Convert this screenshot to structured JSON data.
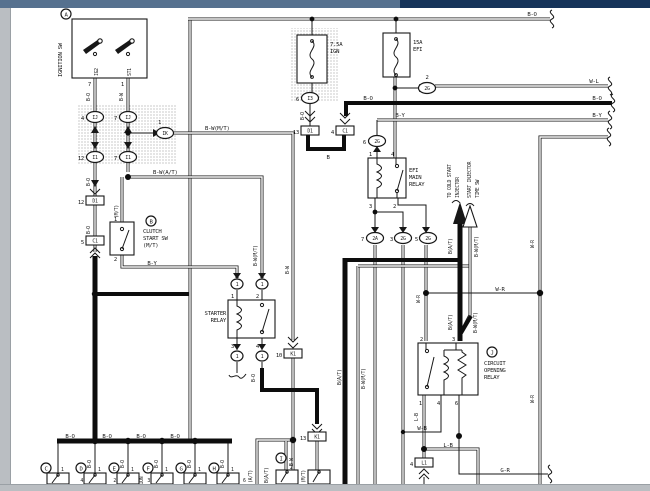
{
  "chrome": {
    "titlebar_left_color": "#56718f",
    "titlebar_right_color": "#16345a",
    "frame_color": "#babec2"
  },
  "ign": {
    "callout": "A",
    "label": "IGNITION SW",
    "t1": "IG2",
    "t2": "ST1",
    "p1": "7",
    "p2": "1"
  },
  "fuses": {
    "ign_a": "7.5A",
    "ign_n": "IGN",
    "efi_a": "15A",
    "efi_n": "EFI"
  },
  "ov": {
    "n1": "1",
    "n2": "2",
    "n3": "3",
    "n4": "4",
    "n5": "5",
    "n6": "6",
    "n7": "7",
    "n12": "12",
    "ij": "IJ",
    "i1": "I1",
    "ik": "IK",
    "i3": "I3",
    "g2": "2G",
    "a2": "2A"
  },
  "pl": {
    "n4": "4",
    "n5": "5",
    "n10": "10",
    "n12": "12",
    "n13": "13",
    "d1": "D1",
    "c1": "C1",
    "k1": "K1",
    "l1": "L1"
  },
  "clutch": {
    "callout": "B",
    "l1": "CLUTCH",
    "l2": "START SW",
    "l3": "(M/T)",
    "p1": "1",
    "p2": "2"
  },
  "starter": {
    "l1": "STARTER",
    "l2": "RELAY",
    "p1": "1",
    "p2": "2",
    "p3": "3",
    "p4": "4",
    "ring": "1"
  },
  "efir": {
    "l1": "EFI",
    "l2": "MAIN",
    "l3": "RELAY",
    "p1": "1",
    "p2": "2",
    "p3": "3",
    "p4": "4"
  },
  "cor": {
    "callout": "J",
    "l1": "CIRCUIT",
    "l2": "OPENING",
    "l3": "RELAY",
    "t2": "2",
    "t3": "3",
    "b1": "1",
    "b4": "4",
    "b6": "6"
  },
  "dest": {
    "c1": "TO COLD START",
    "c2": "INJECTOR",
    "c3": "START INJECTOR",
    "c4": "TIME SW"
  },
  "w": {
    "bo": "B-O",
    "bw": "B-W",
    "by": "B-Y",
    "wl": "W-L",
    "wr": "W-R",
    "gr": "G-R",
    "b": "B",
    "lb": "L-B",
    "wb": "W-B",
    "bat": "B(A/T)",
    "bwmt": "B-W(M/T)",
    "bwat": "B-W(A/T)",
    "mt": "(M/T)",
    "at": "(A/T)"
  },
  "bottom": {
    "c": "C",
    "d": "D",
    "e": "E",
    "f": "F",
    "g": "G",
    "h": "H",
    "i": "I",
    "pin": "1",
    "ipin": "2",
    "nd": "4",
    "ne": "2",
    "nf": "3",
    "nh": "6",
    "partial": "TION"
  }
}
